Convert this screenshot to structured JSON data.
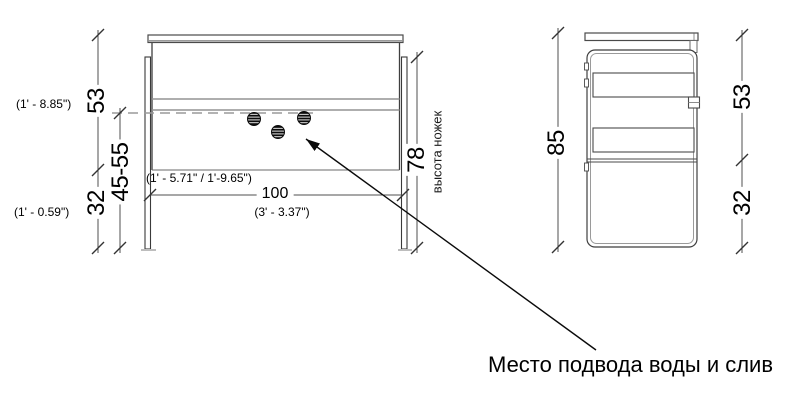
{
  "annotation": {
    "label": "Место подвода воды и слив"
  },
  "front_view": {
    "height_upper_cm": "53",
    "height_upper_imperial": "(1' - 8.85\")",
    "height_lower_cm": "32",
    "height_lower_imperial": "(1' - 0.59\")",
    "supply_height_range_cm": "45-55",
    "supply_height_range_imperial": "(1' - 5.71\" / 1'-9.65\")",
    "width_cm": "100",
    "width_imperial": "(3' - 3.37\")",
    "legs_height_cm": "78",
    "legs_height_label": "высота ножек"
  },
  "side_view": {
    "total_height_cm": "85",
    "upper_section_cm": "53",
    "lower_section_cm": "32"
  },
  "colors": {
    "background": "#ffffff",
    "line_dark": "#3a3a3a",
    "line_mid": "#555555",
    "line_light": "#949494",
    "text": "#000000"
  }
}
